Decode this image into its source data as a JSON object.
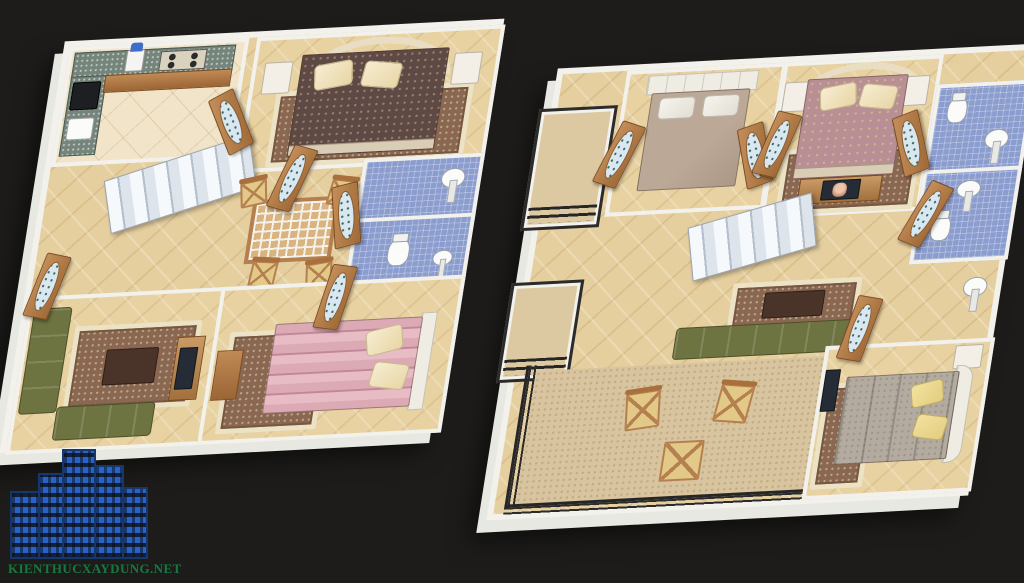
{
  "watermark": {
    "text": "KIENTHUCXAYDUNG.NET",
    "text_color": "#157a40",
    "building_color": "#2a63c8"
  },
  "scene": {
    "type": "3d-floor-plan-render",
    "background_color": "#1d1c1a",
    "floors": [
      {
        "name": "first-floor",
        "position": "left",
        "rooms": [
          "kitchen",
          "bedroom-dark-floral-bed",
          "bathroom-upper",
          "bathroom-lower",
          "staircase-hall",
          "dining-area",
          "living-room",
          "bedroom-pink-bed"
        ],
        "furniture": [
          "granite-counter",
          "gas-stove",
          "water-dispenser",
          "kitchen-sink",
          "double-bed",
          "pillows",
          "nightstands",
          "arched-headboard",
          "pedestal-sink",
          "toilet",
          "white-staircase",
          "dining-table",
          "dining-chairs",
          "green-corner-sofa",
          "coffee-table",
          "area-rugs",
          "tv-cabinet",
          "wooden-doors-with-oval-glass"
        ]
      },
      {
        "name": "second-floor",
        "position": "right",
        "rooms": [
          "balcony-upper",
          "bedroom-taupe-bed",
          "master-bedroom",
          "bathroom-upper",
          "bathroom-lower",
          "staircase-hall",
          "lounge",
          "balcony-middle",
          "terrace",
          "bedroom-grey-bed"
        ],
        "furniture": [
          "double-beds",
          "pillows",
          "nightstands",
          "arched-headboard",
          "tv-dresser",
          "pedestal-sinks",
          "toilets",
          "white-staircase",
          "green-sofa",
          "coffee-table",
          "area-rugs",
          "terrace-chairs",
          "terrace-table",
          "black-metal-railings",
          "wooden-doors-with-oval-glass"
        ]
      }
    ],
    "palette": {
      "wall": "#f2f1ec",
      "floor_tile": "#e6cf9f",
      "terrace_floor": "#d8c49e",
      "bath_tile": "#8b9cce",
      "wood": "#b97f4f",
      "sofa_green": "#6e7342",
      "stairs": "#eef2f7",
      "railing": "#2b2b2b",
      "dark_floral_bed": "#5e4a45",
      "pink_bed": "#d2a0ad",
      "taupe_bed": "#b3a08f",
      "mauve_bed": "#b78f95",
      "grey_bed": "#b3ab9f",
      "pillow_cream": "#f3e6c2",
      "pillow_white": "#f2f0ea",
      "pillow_yellow": "#ecd88e"
    }
  }
}
